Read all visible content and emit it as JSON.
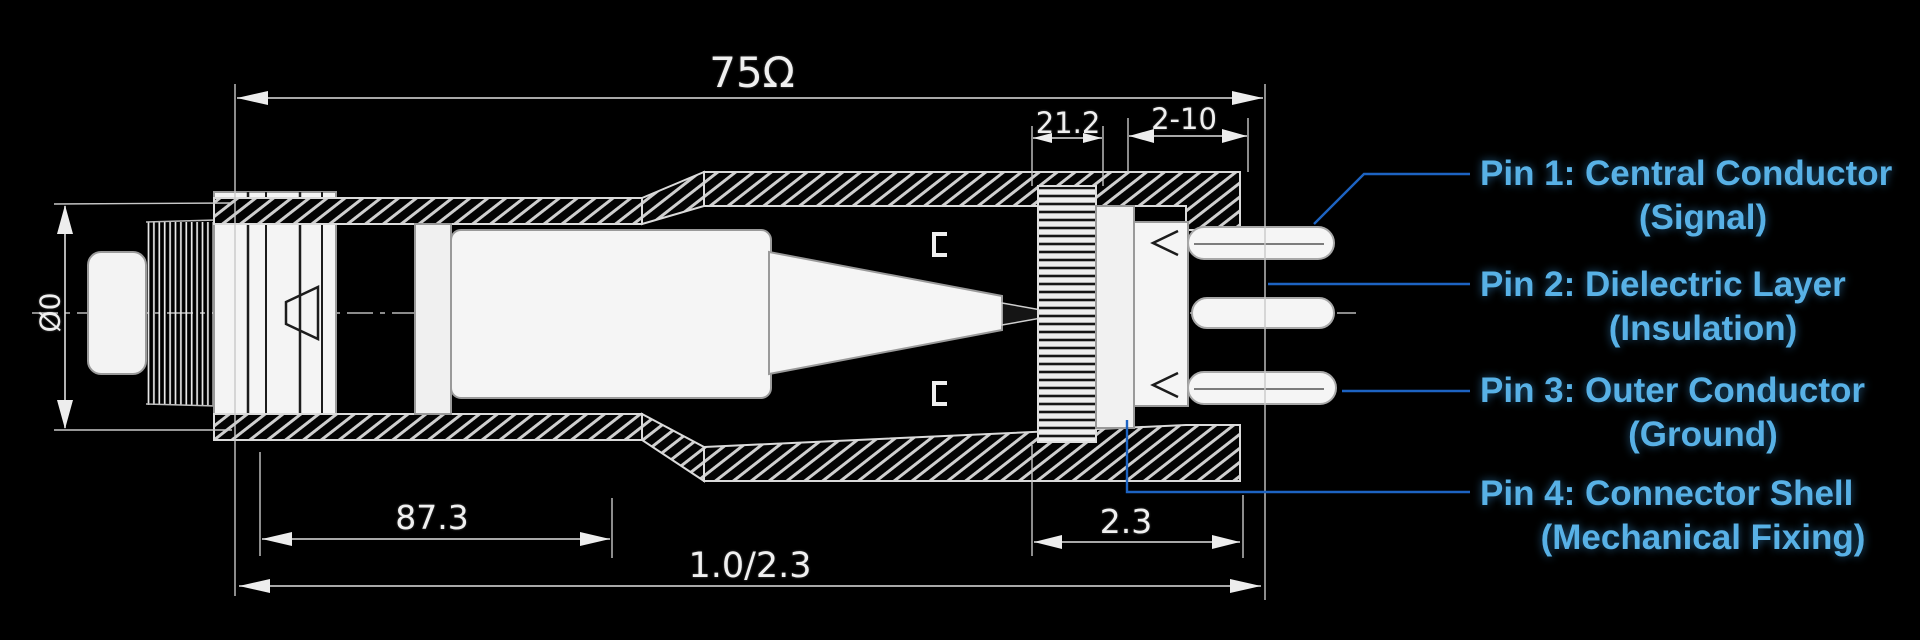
{
  "meta": {
    "description": "Cross-section engineering drawing of a 75-ohm coaxial connector with four labeled pins"
  },
  "colors": {
    "background": "#000000",
    "drawing_line": "#e2e2e2",
    "pin_label_text": "#58b1e6",
    "leader_line": "#1d63c2"
  },
  "dimensions": {
    "impedance": "75Ω",
    "knurl_width": "21.2",
    "pin_spacing": "2-10",
    "thread_diameter": "Ø0",
    "body_length": "87.3",
    "rear_length": "2.3",
    "overall_length": "1.0/2.3"
  },
  "pins": [
    {
      "title": "Pin 1: Central Conductor",
      "subtitle": "(Signal)"
    },
    {
      "title": "Pin 2: Dielectric Layer",
      "subtitle": "(Insulation)"
    },
    {
      "title": "Pin 3: Outer Conductor",
      "subtitle": "(Ground)"
    },
    {
      "title": "Pin 4: Connector Shell",
      "subtitle": "(Mechanical Fixing)"
    }
  ]
}
